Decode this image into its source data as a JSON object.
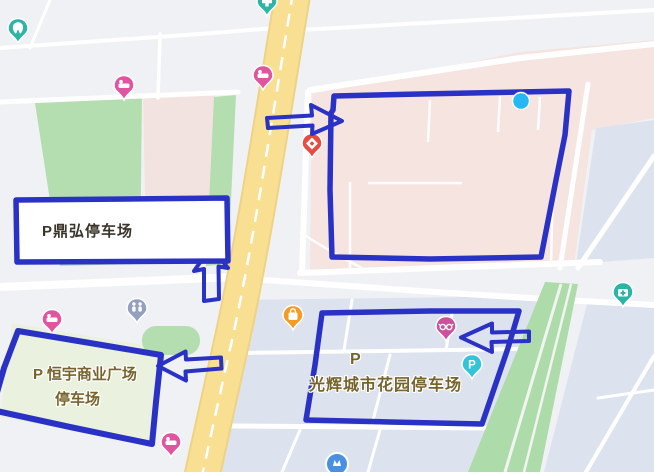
{
  "colors": {
    "annotation_ink": "#2a31c5",
    "location_dot": "#25b8f4"
  },
  "pois": {
    "jiarong_clinic": "佳荣诊所",
    "yixintang_pharmacy": "一心堂药店",
    "jinshui_hotel": "金水温泉酒店",
    "mingchun_hotel": "铭春连锁酒店",
    "children_hospital_south_l1": "昆明市儿童医",
    "children_hospital_south_l2": "院南市区医院",
    "kunmed_children_l1": "昆明医科大学",
    "kunmed_children_l2": "附属儿童医院",
    "hehong_road": "河宏路",
    "xinyue_hotel": "鑫跃商务酒店",
    "guanghui_mall": "光辉时代购物广场",
    "tianxing_skincare": "天杏皮肤护理店",
    "xingbo_glasses": "兴博眼镜店",
    "chunda_hotel": "淳达酒店",
    "yunhe_taekwondo": "云鹤跆拳道",
    "shidai_partial": "时",
    "atm_badge": "ATM",
    "parking_pin_glyph": "P"
  },
  "annotations": {
    "dinghong_parking": "P鼎弘停车场",
    "hengyu_parking_l1": "P 恒宇商业广场",
    "hengyu_parking_l2": "停车场",
    "guanghui_parking_p": "P",
    "guanghui_parking_name": "光辉城市花园停车场"
  }
}
